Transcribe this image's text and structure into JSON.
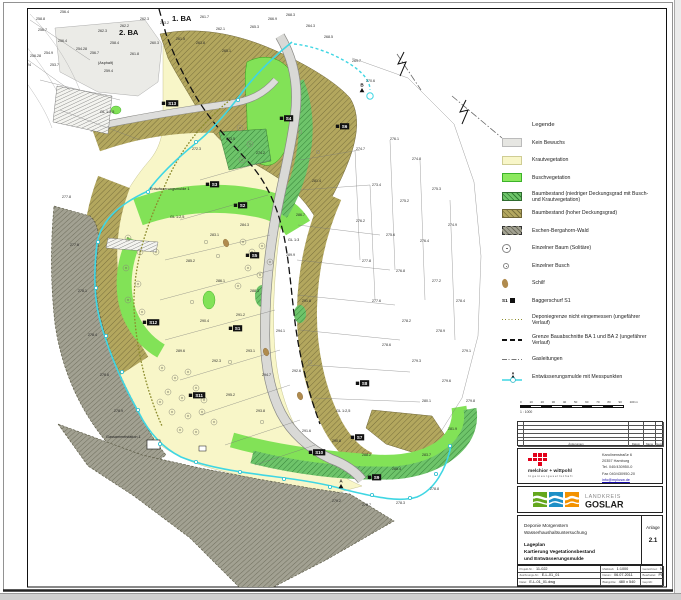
{
  "sheet": {
    "legend": {
      "title": "Legende",
      "items": [
        {
          "label": "Kein Bewuchs"
        },
        {
          "label": "Krautvegetation"
        },
        {
          "label": "Buschvegetation"
        },
        {
          "label": "Baumbestand (niedriger Deckungsgrad mit Busch- und Krautvegetation)"
        },
        {
          "label": "Baumbestand (hoher Deckungsgrad)"
        },
        {
          "label": "Eschen-Bergahorn-Wald"
        },
        {
          "label": "Einzelner Baum (Solitäre)"
        },
        {
          "label": "Einzelner Busch"
        },
        {
          "label": "Schilf"
        },
        {
          "label": "Baggerschurf S1",
          "prefix": "S1"
        },
        {
          "label": "Deponiegrenze nicht eingemessen (ungefährer Verlauf)"
        },
        {
          "label": "Grenze Bauabschnitte BA 1 und BA 2 (ungefährer Verlauf)"
        },
        {
          "label": "Gasleitungen"
        },
        {
          "label": "Entwässerungsmulde mit Messpunkten",
          "point_label": "A"
        }
      ]
    },
    "scalebar": {
      "ticks": [
        "0",
        "10",
        "20",
        "30",
        "40",
        "50",
        "60",
        "70",
        "80",
        "90",
        "100 m"
      ],
      "ratio": "1 : 1000"
    },
    "revision_table": {
      "col_labels": [
        "Änderungen",
        "Datum",
        "Name",
        "Gepr."
      ]
    },
    "company": {
      "name": "melchior + wittpohl",
      "subtitle": "Ingenieurgesellschaft",
      "address_lines": [
        "Karolinenstraße 6",
        "20357 Hamburg",
        "Tel. 040/430950-0",
        "Fax 040/430950-20",
        "info@mplusw.de"
      ]
    },
    "client_logo": {
      "line1": "LANDKREIS",
      "line2": "GOSLAR",
      "colors": [
        "#64a71d",
        "#1d8fc6",
        "#f39200"
      ]
    },
    "title_block": {
      "project_lines": [
        "Deponie Morgenstern",
        "Wasserhaushaltsuntersuchung"
      ],
      "title_lines": [
        "Lageplan",
        "Kartierung Vegetationsbestand",
        "und Entwässerungsmulde"
      ],
      "anlage_label": "Anlage",
      "anlage_no": "2.1",
      "fields": [
        {
          "label": "Projekt-Nr.:",
          "value": "11-022"
        },
        {
          "label": "Maßstab:",
          "value": "1:1000"
        },
        {
          "label": "Gezeichnet:",
          "value": "N"
        },
        {
          "label": "Zeichnungs-Nr.:",
          "value": "E-L-01_01"
        },
        {
          "label": "Datum:",
          "value": "06.07.2011"
        },
        {
          "label": "Bearbeitet:",
          "value": "PD"
        },
        {
          "label": "Datei:",
          "value": "E-L-01_01.dwg"
        },
        {
          "label": "Blattgröße:",
          "value": "480 x 540"
        },
        {
          "label": "Geprüft:",
          "value": ""
        }
      ]
    },
    "map": {
      "ba_labels": [
        {
          "t": "1. BA",
          "x": 172,
          "y": 21
        },
        {
          "t": "2. BA",
          "x": 119,
          "y": 35
        }
      ],
      "area_labels": [
        {
          "t": "(Asphalt)",
          "x": 98,
          "y": 64
        },
        {
          "t": "GL 1:2,5",
          "x": 100,
          "y": 113
        },
        {
          "t": "GL 1:2,5",
          "x": 170,
          "y": 218
        },
        {
          "t": "GL 1:3",
          "x": 288,
          "y": 241
        },
        {
          "t": "GL 1:2,5",
          "x": 336,
          "y": 412
        },
        {
          "t": "Gassammelstation 1",
          "x": 106,
          "y": 438
        },
        {
          "t": "Entwässerungsmulde 1",
          "x": 150,
          "y": 190
        }
      ],
      "excavation_markers": [
        {
          "label": "S1",
          "x": 233,
          "y": 331
        },
        {
          "label": "S2",
          "x": 238,
          "y": 208
        },
        {
          "label": "S3",
          "x": 210,
          "y": 187
        },
        {
          "label": "S4",
          "x": 284,
          "y": 121
        },
        {
          "label": "S5",
          "x": 250,
          "y": 258
        },
        {
          "label": "S6",
          "x": 340,
          "y": 129
        },
        {
          "label": "S7",
          "x": 355,
          "y": 440
        },
        {
          "label": "S8",
          "x": 360,
          "y": 386
        },
        {
          "label": "S9",
          "x": 372,
          "y": 480
        },
        {
          "label": "S10",
          "x": 313,
          "y": 455
        },
        {
          "label": "S11",
          "x": 193,
          "y": 398
        },
        {
          "label": "S12",
          "x": 147,
          "y": 325
        },
        {
          "label": "S13",
          "x": 166,
          "y": 106
        }
      ],
      "measure_points": [
        {
          "label": "A",
          "x": 341,
          "y": 484
        },
        {
          "label": "B",
          "x": 362,
          "y": 88
        }
      ],
      "channel_points": [
        [
          238,
          100
        ],
        [
          196,
          142
        ],
        [
          148,
          192
        ],
        [
          98,
          242
        ],
        [
          96,
          288
        ],
        [
          106,
          336
        ],
        [
          122,
          372
        ],
        [
          138,
          410
        ],
        [
          160,
          444
        ],
        [
          196,
          462
        ],
        [
          240,
          472
        ],
        [
          284,
          479
        ],
        [
          330,
          487
        ],
        [
          372,
          495
        ],
        [
          410,
          498
        ],
        [
          436,
          474
        ],
        [
          450,
          446
        ]
      ],
      "tree_symbols": [
        [
          162,
          368
        ],
        [
          175,
          378
        ],
        [
          188,
          372
        ],
        [
          168,
          392
        ],
        [
          182,
          398
        ],
        [
          196,
          388
        ],
        [
          204,
          400
        ],
        [
          172,
          412
        ],
        [
          188,
          416
        ],
        [
          202,
          412
        ],
        [
          214,
          422
        ],
        [
          180,
          430
        ],
        [
          196,
          432
        ],
        [
          160,
          402
        ],
        [
          243,
          242
        ],
        [
          252,
          252
        ],
        [
          262,
          246
        ],
        [
          248,
          268
        ],
        [
          260,
          275
        ],
        [
          270,
          262
        ],
        [
          238,
          286
        ],
        [
          128,
          238
        ],
        [
          140,
          252
        ],
        [
          126,
          268
        ],
        [
          138,
          284
        ],
        [
          128,
          300
        ],
        [
          142,
          312
        ],
        [
          156,
          252
        ],
        [
          240,
          128
        ],
        [
          250,
          144
        ],
        [
          242,
          160
        ]
      ],
      "bush_symbols": [
        [
          300,
          132
        ],
        [
          318,
          152
        ],
        [
          206,
          242
        ],
        [
          218,
          256
        ],
        [
          192,
          302
        ],
        [
          230,
          362
        ],
        [
          262,
          422
        ],
        [
          310,
          362
        ]
      ],
      "reed_blobs": [
        [
          226,
          243
        ],
        [
          266,
          352
        ],
        [
          300,
          396
        ]
      ],
      "spot_elevations": [
        [
          14,
          57,
          "255.24"
        ],
        [
          30,
          57,
          "256.28"
        ],
        [
          44,
          54,
          "254.9"
        ],
        [
          20,
          66,
          "256.24"
        ],
        [
          50,
          66,
          "253.7"
        ],
        [
          36,
          20,
          "258.8"
        ],
        [
          60,
          13,
          "256.4"
        ],
        [
          38,
          31,
          "256.7"
        ],
        [
          58,
          42,
          "256.4"
        ],
        [
          76,
          50,
          "254.28"
        ],
        [
          90,
          54,
          "256.7"
        ],
        [
          110,
          44,
          "258.4"
        ],
        [
          98,
          32,
          "262.3"
        ],
        [
          120,
          27,
          "262.2"
        ],
        [
          140,
          20,
          "262.3"
        ],
        [
          160,
          24,
          "263.2"
        ],
        [
          176,
          40,
          "261.5"
        ],
        [
          150,
          44,
          "260.3"
        ],
        [
          130,
          55,
          "261.8"
        ],
        [
          104,
          72,
          "259.4"
        ],
        [
          200,
          18,
          "261.7"
        ],
        [
          216,
          30,
          "262.1"
        ],
        [
          196,
          44,
          "263.8"
        ],
        [
          222,
          52,
          "265.1"
        ],
        [
          250,
          28,
          "265.3"
        ],
        [
          268,
          20,
          "266.9"
        ],
        [
          286,
          16,
          "268.3"
        ],
        [
          306,
          27,
          "264.3"
        ],
        [
          324,
          38,
          "268.5"
        ],
        [
          352,
          62,
          "269.7"
        ],
        [
          366,
          82,
          "270.6"
        ],
        [
          356,
          150,
          "274.7"
        ],
        [
          390,
          140,
          "276.1"
        ],
        [
          412,
          160,
          "274.8"
        ],
        [
          372,
          186,
          "273.4"
        ],
        [
          400,
          202,
          "275.2"
        ],
        [
          432,
          190,
          "275.3"
        ],
        [
          356,
          222,
          "276.2"
        ],
        [
          386,
          236,
          "275.6"
        ],
        [
          420,
          242,
          "276.4"
        ],
        [
          448,
          226,
          "274.9"
        ],
        [
          362,
          262,
          "277.8"
        ],
        [
          396,
          272,
          "276.8"
        ],
        [
          432,
          282,
          "277.2"
        ],
        [
          456,
          302,
          "278.4"
        ],
        [
          372,
          302,
          "277.6"
        ],
        [
          402,
          322,
          "278.2"
        ],
        [
          436,
          332,
          "278.9"
        ],
        [
          462,
          352,
          "279.1"
        ],
        [
          382,
          346,
          "278.6"
        ],
        [
          412,
          362,
          "279.3"
        ],
        [
          442,
          382,
          "279.6"
        ],
        [
          466,
          402,
          "279.8"
        ],
        [
          422,
          402,
          "280.1"
        ],
        [
          448,
          430,
          "281.9"
        ],
        [
          62,
          198,
          "277.8"
        ],
        [
          70,
          246,
          "277.6"
        ],
        [
          78,
          292,
          "278.1"
        ],
        [
          88,
          336,
          "278.4"
        ],
        [
          100,
          376,
          "278.6"
        ],
        [
          114,
          412,
          "278.9"
        ],
        [
          192,
          150,
          "272.3"
        ],
        [
          226,
          140,
          "273.5"
        ],
        [
          256,
          154,
          "274.2"
        ],
        [
          210,
          236,
          "283.1"
        ],
        [
          240,
          226,
          "284.3"
        ],
        [
          186,
          262,
          "285.2"
        ],
        [
          216,
          282,
          "286.1"
        ],
        [
          250,
          292,
          "288.3"
        ],
        [
          200,
          322,
          "290.4"
        ],
        [
          236,
          316,
          "291.2"
        ],
        [
          176,
          352,
          "289.6"
        ],
        [
          212,
          362,
          "292.3"
        ],
        [
          246,
          352,
          "293.1"
        ],
        [
          276,
          332,
          "294.1"
        ],
        [
          262,
          376,
          "294.7"
        ],
        [
          226,
          396,
          "295.2"
        ],
        [
          256,
          412,
          "293.8"
        ],
        [
          292,
          372,
          "292.6"
        ],
        [
          302,
          302,
          "291.8"
        ],
        [
          286,
          256,
          "289.9"
        ],
        [
          296,
          216,
          "286.7"
        ],
        [
          312,
          182,
          "281.4"
        ],
        [
          302,
          432,
          "291.6"
        ],
        [
          332,
          442,
          "290.8"
        ],
        [
          362,
          456,
          "288.2"
        ],
        [
          392,
          470,
          "285.4"
        ],
        [
          422,
          456,
          "283.7"
        ],
        [
          332,
          502,
          "279.2"
        ],
        [
          362,
          506,
          "278.7"
        ],
        [
          396,
          504,
          "278.3"
        ],
        [
          430,
          490,
          "278.8"
        ]
      ]
    }
  }
}
